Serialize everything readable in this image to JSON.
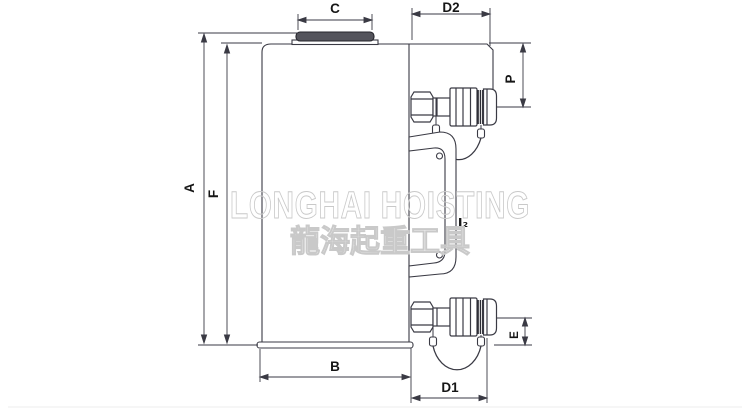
{
  "title": "hydraulic-cylinder-dimension-drawing",
  "watermark": {
    "line1": "LONGHAI HOISTING",
    "line2": "龍海起重工具"
  },
  "dimensions": {
    "a": "A",
    "f": "F",
    "b": "B",
    "c": "C",
    "d1": "D1",
    "d2": "D2",
    "p": "P",
    "e": "E",
    "i2": "I₂"
  },
  "colors": {
    "line": "#3a3a44",
    "label": "#161616",
    "watermark_outline": "#c9c9c9",
    "saddle_fill": "#54545c",
    "coupler_ring_fill": "#2e2e36",
    "background": "#ffffff"
  }
}
